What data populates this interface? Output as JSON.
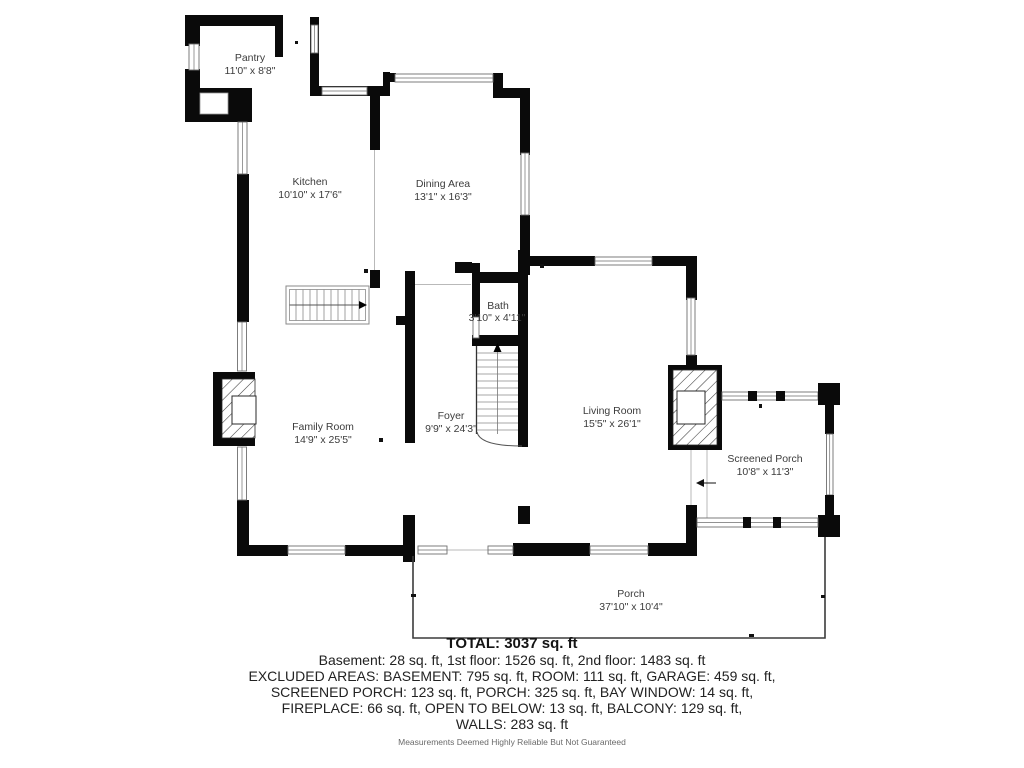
{
  "title": "Floor plan",
  "rooms": [
    {
      "name": "Pantry",
      "dims": "11'0\" x 8'8\""
    },
    {
      "name": "Kitchen",
      "dims": "10'10\" x 17'6\""
    },
    {
      "name": "Dining Area",
      "dims": "13'1\" x 16'3\""
    },
    {
      "name": "Bath",
      "dims": "3'10\" x 4'11\""
    },
    {
      "name": "Family Room",
      "dims": "14'9\" x 25'5\""
    },
    {
      "name": "Foyer",
      "dims": "9'9\" x 24'3\""
    },
    {
      "name": "Living Room",
      "dims": "15'5\" x 26'1\""
    },
    {
      "name": "Screened Porch",
      "dims": "10'8\" x 11'3\""
    },
    {
      "name": "Porch",
      "dims": "37'10\" x 10'4\""
    }
  ],
  "summary": {
    "total": "TOTAL: 3037 sq. ft",
    "line1": "Basement: 28 sq. ft, 1st floor: 1526 sq. ft, 2nd floor: 1483 sq. ft",
    "line2": "EXCLUDED AREAS: BASEMENT: 795 sq. ft, ROOM: 111 sq. ft, GARAGE: 459 sq. ft,",
    "line3": "SCREENED PORCH: 123 sq. ft, PORCH: 325 sq. ft, BAY WINDOW: 14 sq. ft,",
    "line4": "FIREPLACE: 66 sq. ft, OPEN TO BELOW: 13 sq. ft, BALCONY: 129 sq. ft,",
    "line5": "WALLS: 283 sq. ft",
    "disclaimer": "Measurements Deemed Highly Reliable But Not Guaranteed"
  },
  "colors": {
    "wall": "#0a0a0a",
    "room_label": "#3c3c3c",
    "summary_text": "#222222",
    "disclaimer_text": "#6a6a6a",
    "background": "#ffffff"
  }
}
